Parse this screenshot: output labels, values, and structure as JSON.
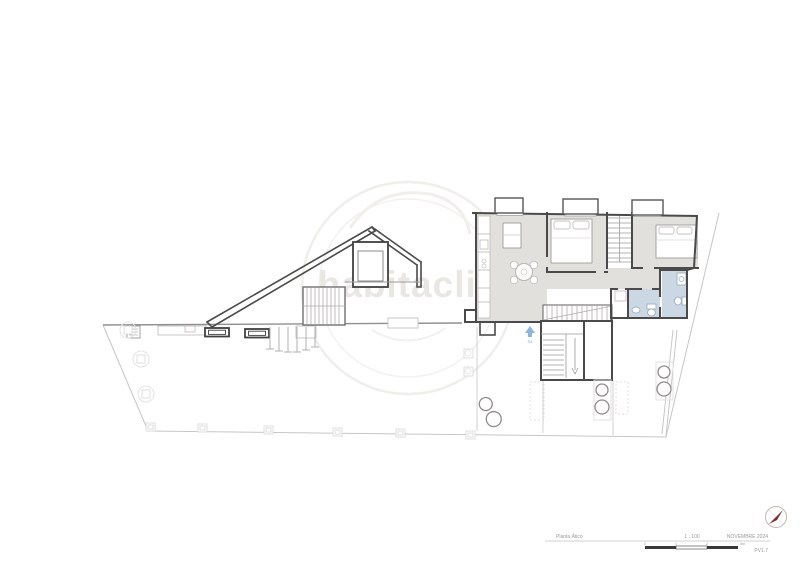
{
  "watermark": {
    "brand": "habitaclia",
    "color": "#e9e7e4"
  },
  "plan": {
    "entrance_label": "S4",
    "colors": {
      "floor": "#e2e0dc",
      "shaft": "#dcdad6",
      "bathroom_tile": "#cbd8e4",
      "wall": "#4a4a4a",
      "boundary": "#c6c6c6",
      "entrance_arrow": "#8ab6dc"
    }
  },
  "title_block": {
    "drawing_name": "Planta Ático",
    "scale": "1 : 100",
    "date": "NOVEMBRE 2024",
    "sheet_code": "PV1.7",
    "scale_bar": {
      "labels": [
        "0",
        "1",
        "2",
        "5m"
      ]
    }
  },
  "compass": {
    "needle_color": "#7a2f35"
  }
}
